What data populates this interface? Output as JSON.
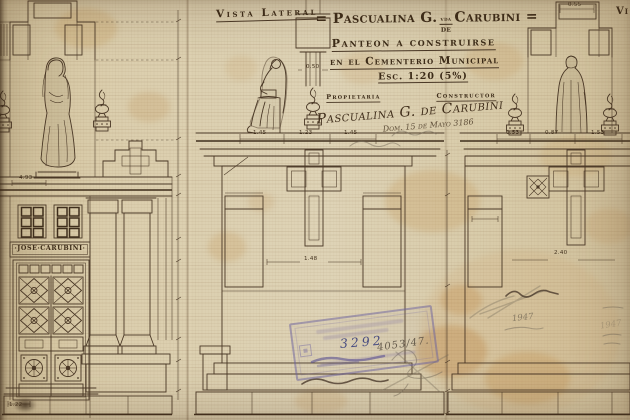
{
  "document_type": "architectural drawing - mausoleum elevations",
  "labels": {
    "vista_lateral": "Vista Lateral",
    "vista_right_partial": "Vi"
  },
  "title_block": {
    "title_part1": "= Pascualina G.",
    "title_sup": "vda",
    "title_mid": "de",
    "title_part2": "Carubini =",
    "subtitle1": "Panteon a construirse",
    "subtitle2": "en el Cementerio Municipal",
    "scale": "Esc. 1:20 (5%)",
    "owner_label": "Propietaria",
    "builder_label": "Constructor",
    "owner_signature": "Pascualina G. de Carubini",
    "address_note": "Dom. 15 de Mayo 3186"
  },
  "facade": {
    "nameplate": "·JOSE·CARUBINI·"
  },
  "annotations": {
    "stamp_number": "3292",
    "file_number": "4053/47.",
    "year_note_left": "1947",
    "year_note_right": "1947"
  },
  "dimensions": [
    {
      "value": "4.93"
    },
    {
      "value": "0.50"
    },
    {
      "value": "1.45"
    },
    {
      "value": "1.23"
    },
    {
      "value": "1.45"
    },
    {
      "value": "1.48"
    },
    {
      "value": "0.55"
    },
    {
      "value": "0.53"
    },
    {
      "value": "0.87"
    },
    {
      "value": "1.53"
    },
    {
      "value": "2.40"
    },
    {
      "value": "1.22"
    }
  ],
  "colors": {
    "paper": "#d8cbaa",
    "ink": "#4a3826",
    "stamp": "#6c61a0",
    "pencil": "#7d7260",
    "stain": "#c08c4e"
  }
}
